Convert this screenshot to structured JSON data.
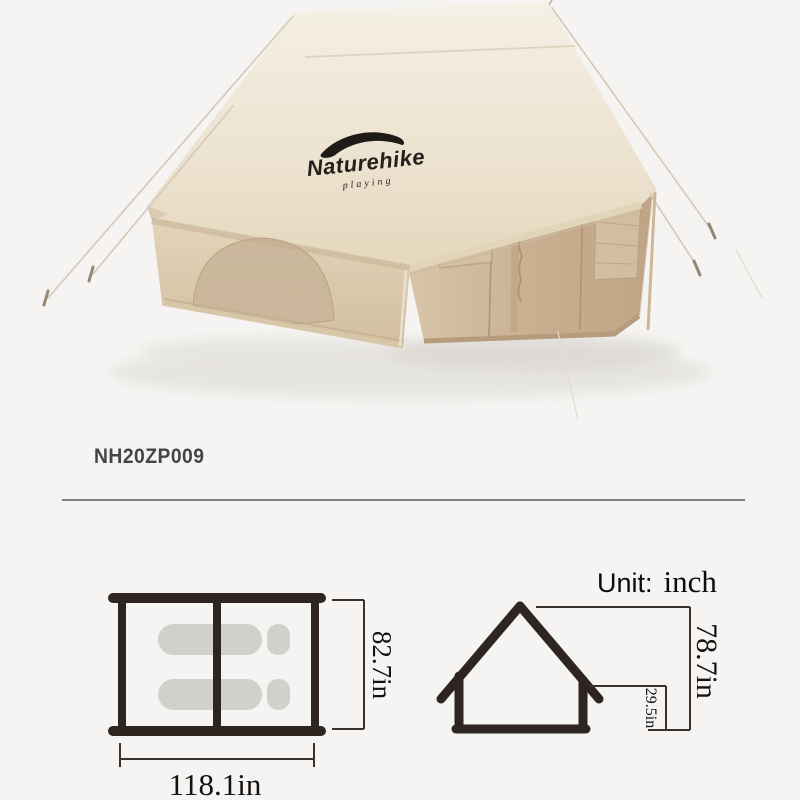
{
  "product": {
    "brand": "Naturehike",
    "brand_tagline": "playing",
    "model": "NH20ZP009",
    "item": "beige cotton inflatable cabin tent"
  },
  "icons": {
    "brand_swoosh": "mountain-swoosh"
  },
  "unit_label": {
    "prefix": "Unit:",
    "value": "inch"
  },
  "diagrams": {
    "unit": "inch",
    "floorplan": {
      "width_label": "118.1in",
      "depth_label": "82.7in",
      "width_in": 118.1,
      "depth_in": 82.7,
      "rooms": 2,
      "sleeping_pads": 2
    },
    "elevation": {
      "peak_height_label": "78.7in",
      "wall_height_label": "29.5in",
      "peak_height_in": 78.7,
      "wall_height_in": 29.5
    }
  },
  "colors": {
    "bg": "#f5f4f2",
    "roof_cream": "#ece2cf",
    "wall_tan": "#c9b194",
    "rope": "#d5cbb8",
    "diagram_line": "#2e2521",
    "dim_line": "#3a332d",
    "dim_text": "#14110e",
    "pad_fill": "#d2d0ca",
    "model_text": "#454545",
    "divider": "#7e7e7e"
  }
}
